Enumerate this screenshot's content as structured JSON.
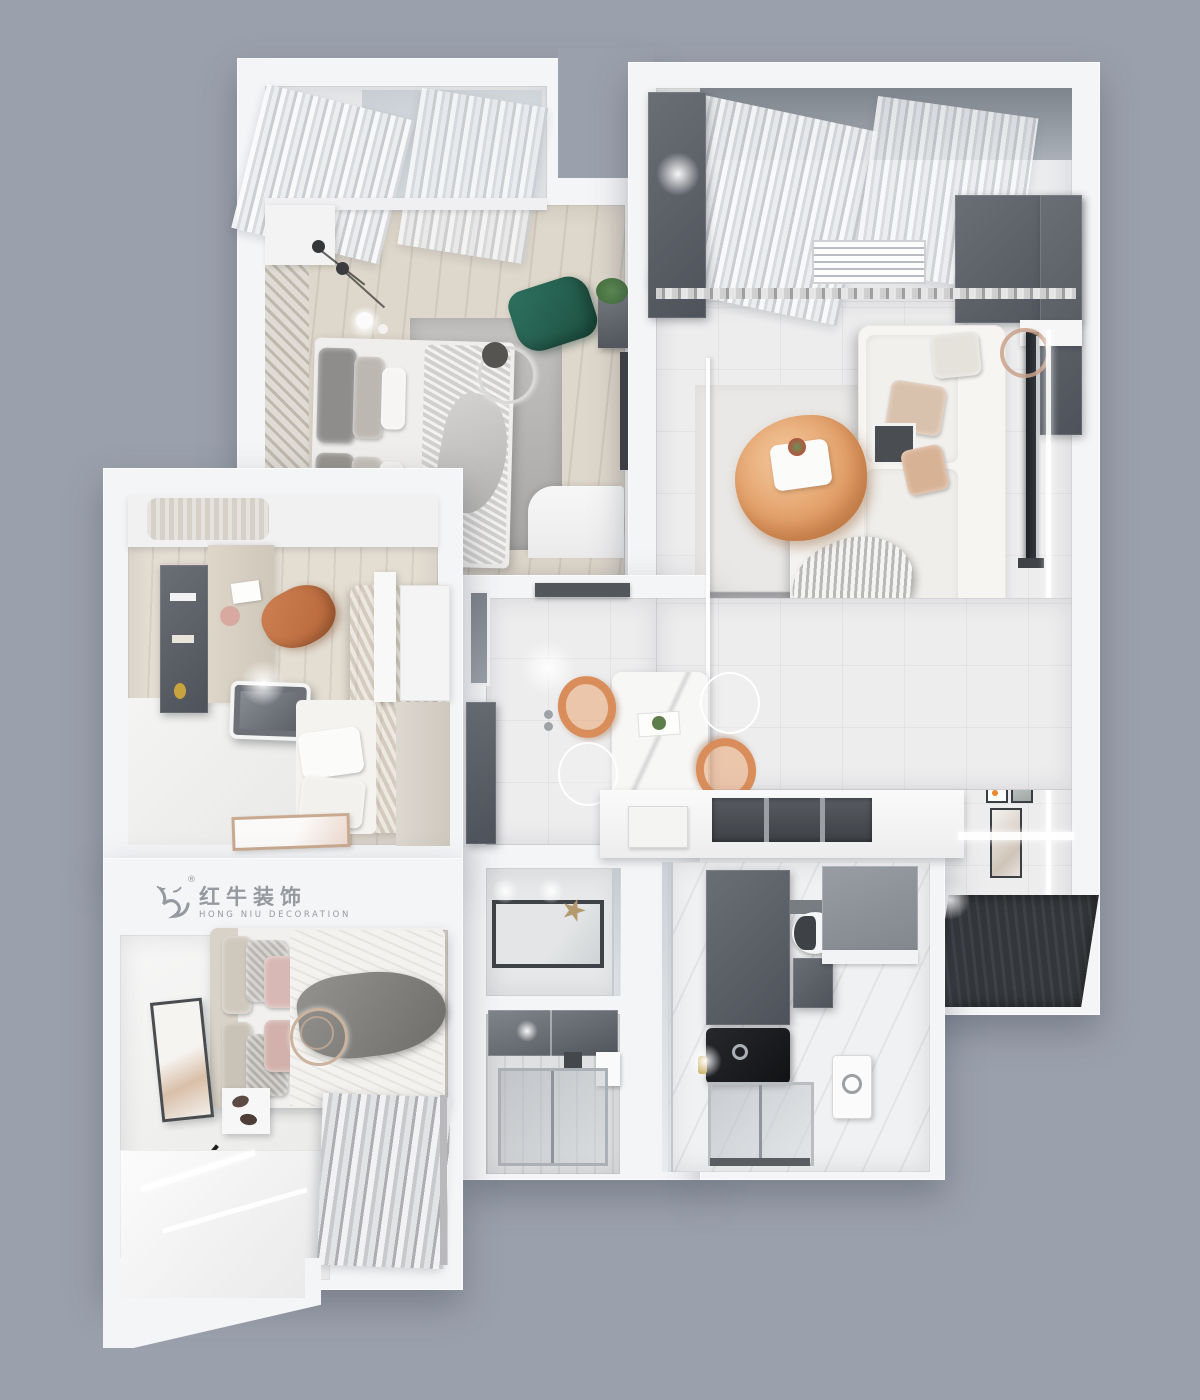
{
  "canvas": {
    "width": 1200,
    "height": 1400,
    "background_color": "#9ba1ac"
  },
  "watermark": {
    "brand_zh": "红牛装饰",
    "brand_en": "HONG NIU DECORATION",
    "registered": "®",
    "text_color": "#96999f",
    "logo_icon": "hongniu-bull-logo"
  },
  "palette": {
    "wall_white": "#f4f5f7",
    "floor_wood": "#ded7cb",
    "floor_tile": "#ededee",
    "accent_orange": "#dd9563",
    "accent_teal": "#2d6e5b",
    "cabinet_dark_gray": "#5a5e64",
    "entry_mat_dark": "#33363a",
    "glass_gray": "#9aa2ab"
  },
  "rooms": [
    {
      "id": "bedroom-top-left",
      "furniture": [
        "balcony-curtains",
        "window",
        "double-bed",
        "gray-rug",
        "ring-light",
        "pendant-lights",
        "green-lounge-chair",
        "plant-stand",
        "wardrobe",
        "nightstand",
        "corner-desk"
      ]
    },
    {
      "id": "living-room",
      "furniture": [
        "balcony-curtains",
        "air-conditioning-vent",
        "dark-wardrobe",
        "white-sectional-sofa",
        "throw-pillows",
        "knit-blanket",
        "orange-coffee-table",
        "glass-side-table",
        "tv-panel",
        "copper-ring-decor",
        "gallery-frames",
        "area-rug",
        "entry-mat"
      ]
    },
    {
      "id": "study-bedroom",
      "furniture": [
        "wall-shelf",
        "desk",
        "orange-desk-chair",
        "monitor",
        "single-bed",
        "wardrobe",
        "floor-artwork"
      ]
    },
    {
      "id": "dining-kitchen",
      "furniture": [
        "dining-table",
        "orange-chairs",
        "ghost-chairs",
        "glass-partition",
        "kitchen-counter",
        "sink",
        "wall-cabinets",
        "window"
      ]
    },
    {
      "id": "bathroom-center-top",
      "furniture": [
        "shower-tray",
        "glass-screen",
        "starfish-decor"
      ]
    },
    {
      "id": "bathroom-center-bottom",
      "furniture": [
        "mirror-cabinet",
        "shower-glass",
        "washbasin"
      ]
    },
    {
      "id": "bathroom-right",
      "furniture": [
        "toilet",
        "black-washbasin",
        "dark-vanity",
        "shower-enclosure",
        "washing-machine"
      ]
    },
    {
      "id": "master-bedroom",
      "furniture": [
        "double-bed",
        "pink-pillows",
        "gray-throw",
        "ring-pendant-light",
        "nightstand",
        "slippers",
        "wall-artwork",
        "window-seat",
        "curtains",
        "brand-watermark"
      ]
    }
  ]
}
